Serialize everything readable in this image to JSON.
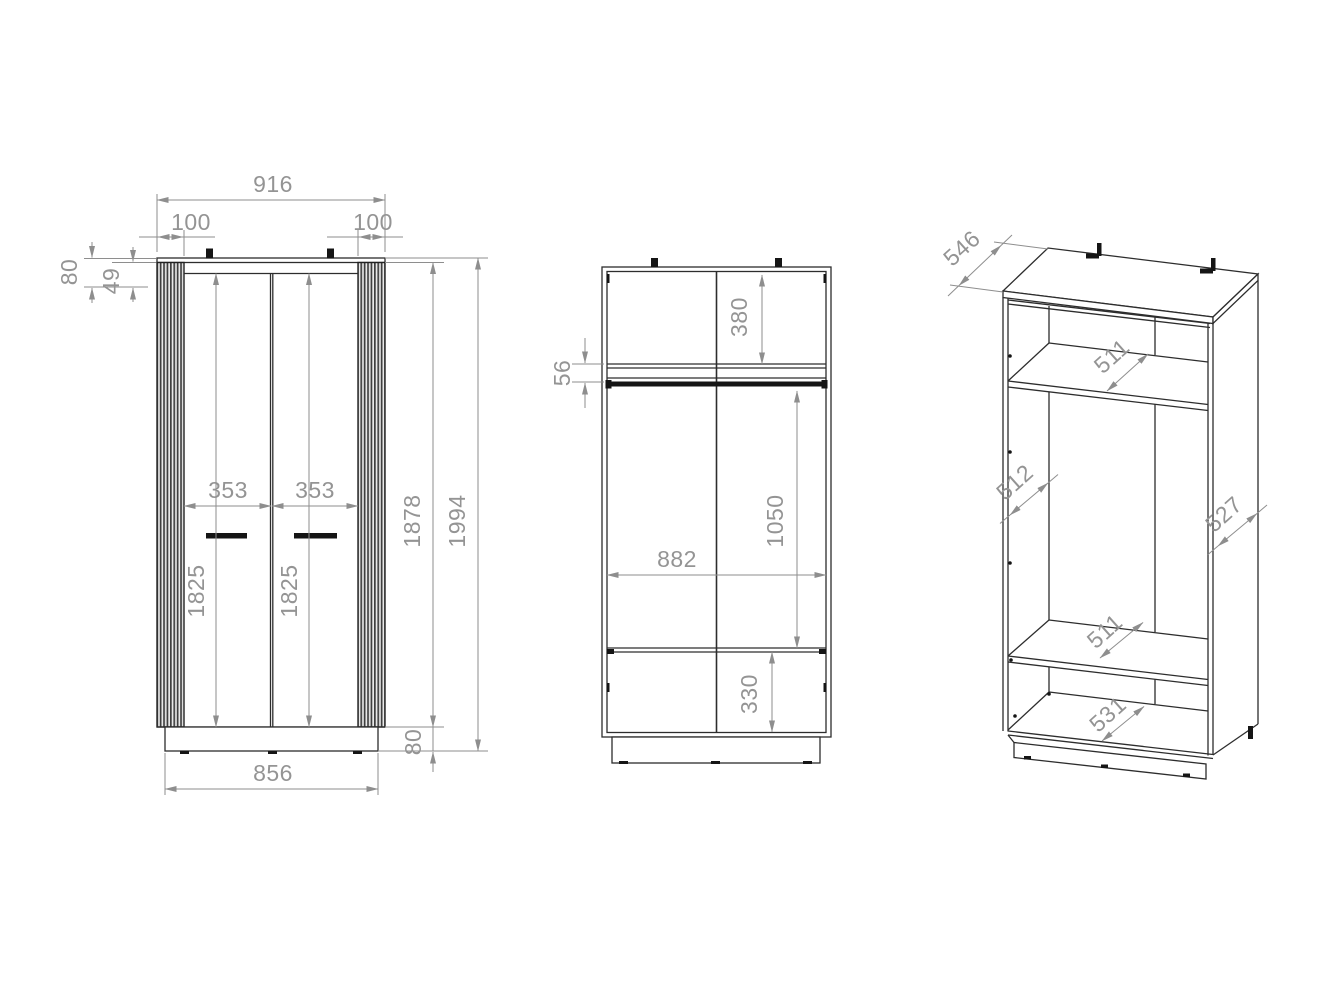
{
  "drawing": {
    "subject": "two-door wardrobe technical dimension drawing",
    "views": {
      "front": {
        "overall_width": "916",
        "left_offset": "100",
        "right_offset": "100",
        "top_height": "80",
        "top_rail": "49",
        "left_door_width": "353",
        "right_door_width": "353",
        "left_door_height": "1825",
        "right_door_height": "1825",
        "carcass_height": "1878",
        "overall_height": "1994",
        "plinth_height": "80",
        "base_width": "856"
      },
      "internal": {
        "top_section": "380",
        "rail_gap": "56",
        "interior_width": "882",
        "middle_section": "1050",
        "bottom_section": "330"
      },
      "perspective": {
        "depth": "546",
        "top_shelf_depth": "511",
        "left_interior_depth": "512",
        "right_side_depth": "527",
        "lower_shelf_depth": "511",
        "bottom_depth": "531"
      }
    }
  }
}
